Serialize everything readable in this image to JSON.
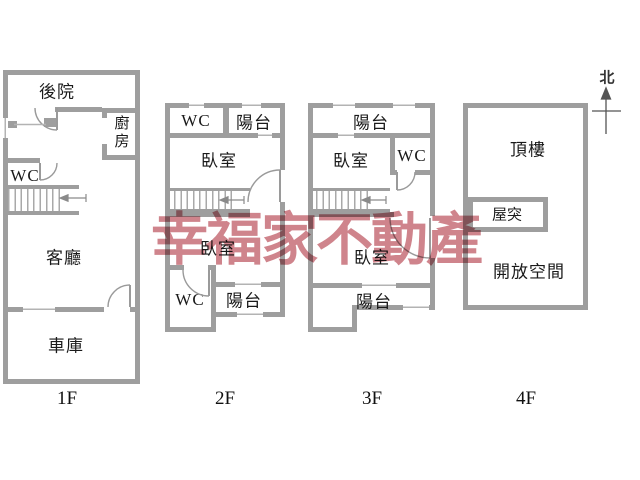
{
  "watermark": {
    "text": "幸福家不動產",
    "color": "#c9737c"
  },
  "compass": {
    "north_label": "北"
  },
  "colors": {
    "wall": "#9e9e9e",
    "window": "#b3b3b3",
    "text": "#1a1a1a",
    "watermark": "#c9737c",
    "background": "#ffffff"
  },
  "floors": [
    {
      "label": "1F",
      "rooms": {
        "backyard": "後院",
        "kitchen": "廚房",
        "wc": "WC",
        "living_room": "客廳",
        "garage": "車庫"
      }
    },
    {
      "label": "2F",
      "rooms": {
        "wc_upper": "WC",
        "balcony_upper": "陽台",
        "bedroom_upper": "臥室",
        "bedroom_lower": "臥室",
        "wc_lower": "WC",
        "balcony_lower": "陽台"
      }
    },
    {
      "label": "3F",
      "rooms": {
        "balcony_upper": "陽台",
        "bedroom_upper": "臥室",
        "wc": "WC",
        "bedroom_lower": "臥室",
        "balcony_lower": "陽台"
      }
    },
    {
      "label": "4F",
      "rooms": {
        "roof": "頂樓",
        "penthouse": "屋突",
        "open_space": "開放空間"
      }
    }
  ]
}
